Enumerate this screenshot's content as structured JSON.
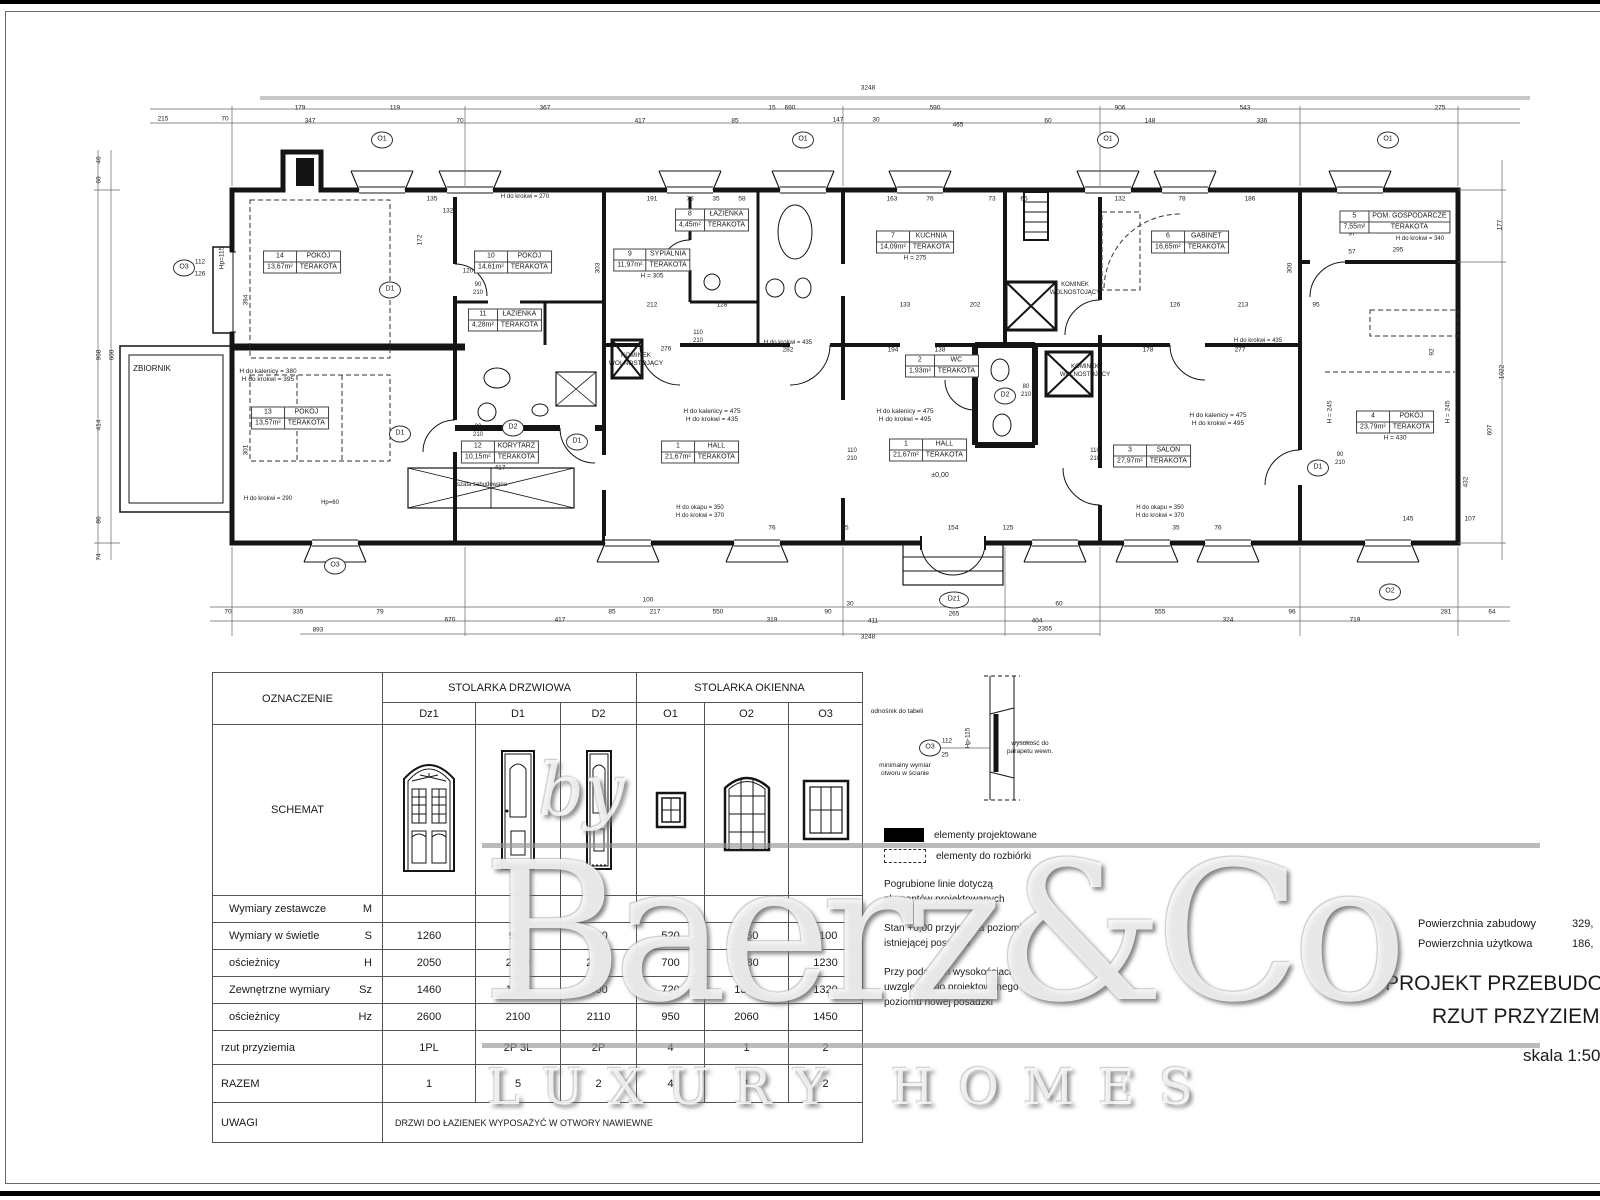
{
  "titleblock": {
    "area_label1": "Powierzchnia zabudowy",
    "area_value1": "329,",
    "area_label2": "Powierzchnia użytkowa",
    "area_value2": "186,",
    "title1": "PROJEKT PRZEBUDOWY",
    "title2": "RZUT PRZYZIEMIA",
    "scale": "skala 1:50"
  },
  "watermark": {
    "by": "by",
    "brand": "Baerz&Co",
    "tagline": "LUXURY HOMES"
  },
  "legend": {
    "items": [
      {
        "label": "elementy projektowane",
        "swatch": "black-fill"
      },
      {
        "label": "elementy do rozbiórki",
        "swatch": "dashed-outline"
      }
    ],
    "notes": [
      [
        "Pogrubione linie dotyczą",
        "elementów projektowanych"
      ],
      [
        "Stan +0,00 przyjęto na poziomie",
        "istniejącej posadzki"
      ],
      [
        "Przy podanych wysokościach",
        "uwzględniono projektowanego",
        "poziomu nowej posadzki"
      ]
    ]
  },
  "table": {
    "corner": "OZNACZENIE",
    "group1": "STOLARKA DRZWIOWA",
    "group2": "STOLARKA OKIENNA",
    "schemat_label": "SCHEMAT",
    "cols": [
      "Dz1",
      "D1",
      "D2",
      "O1",
      "O2",
      "O3"
    ],
    "rows": [
      {
        "label": "Wymiary zestawcze",
        "sub": "M",
        "cls": "r27",
        "values": [
          "",
          "",
          "",
          "",
          "",
          ""
        ]
      },
      {
        "label": "Wymiary w świetle",
        "sub": "S",
        "cls": "r27",
        "values": [
          "1260",
          "900",
          "700",
          "520",
          "1160",
          "1100"
        ]
      },
      {
        "label": "ościeżnicy",
        "sub": "H",
        "cls": "r27",
        "values": [
          "2050",
          "2050",
          "2020",
          "700",
          "1880",
          "1230"
        ]
      },
      {
        "label": "Zewnętrzne wymiary",
        "sub": "Sz",
        "cls": "r27",
        "values": [
          "1460",
          "1000",
          "800",
          "720",
          "1340",
          "1320"
        ]
      },
      {
        "label": "ościeżnicy",
        "sub": "Hz",
        "cls": "r27",
        "values": [
          "2600",
          "2100",
          "2110",
          "950",
          "2060",
          "1450"
        ]
      },
      {
        "label": "rzut przyziemia",
        "sub": "",
        "cls": "rzut",
        "values": [
          "1PL",
          "2P  3L",
          "2P",
          "4",
          "1",
          "2"
        ]
      },
      {
        "label": "RAZEM",
        "sub": "",
        "cls": "razem",
        "values": [
          "1",
          "5",
          "2",
          "4",
          "1",
          "2"
        ]
      },
      {
        "label": "UWAGI",
        "sub": "",
        "cls": "uwagi",
        "span": "DRZWI DO ŁAZIENEK WYPOSAŻYĆ W OTWORY NAWIEWNE"
      }
    ]
  },
  "plan": {
    "rooms": [
      {
        "num": "14",
        "name": "POKÓJ",
        "area": "13,67m²",
        "fin": "TERAKOTA",
        "x": 302,
        "y": 262
      },
      {
        "num": "13",
        "name": "POKÓJ",
        "area": "13,57m²",
        "fin": "TERAKOTA",
        "x": 290,
        "y": 418
      },
      {
        "num": "10",
        "name": "POKÓJ",
        "area": "14,61m²",
        "fin": "TERAKOTA",
        "x": 513,
        "y": 262
      },
      {
        "num": "11",
        "name": "ŁAZIENKA",
        "area": "4,28m²",
        "fin": "TERAKOTA",
        "x": 505,
        "y": 320
      },
      {
        "num": "12",
        "name": "KORYTARZ",
        "area": "10,15m²",
        "fin": "TERAKOTA",
        "x": 500,
        "y": 452,
        "extra": "417"
      },
      {
        "num": "9",
        "name": "SYPIALNIA",
        "area": "11,97m²",
        "fin": "TERAKOTA",
        "x": 652,
        "y": 260,
        "extra": "H = 305"
      },
      {
        "num": "8",
        "name": "ŁAZIENKA",
        "area": "4,45m²",
        "fin": "TERAKOTA",
        "x": 712,
        "y": 220
      },
      {
        "num": "7",
        "name": "KUCHNIA",
        "area": "14,09m²",
        "fin": "TERAKOTA",
        "x": 915,
        "y": 242,
        "extra": "H = 275"
      },
      {
        "num": "1",
        "name": "HALL",
        "area": "21,67m²",
        "fin": "TERAKOTA",
        "x": 700,
        "y": 452
      },
      {
        "num": "1",
        "name": "HALL",
        "area": "21,67m²",
        "fin": "TERAKOTA",
        "x": 928,
        "y": 450
      },
      {
        "num": "2",
        "name": "WC",
        "area": "1,93m²",
        "fin": "TERAKOTA",
        "x": 942,
        "y": 366
      },
      {
        "num": "6",
        "name": "GABINET",
        "area": "16,65m²",
        "fin": "TERAKOTA",
        "x": 1190,
        "y": 242
      },
      {
        "num": "3",
        "name": "SALON",
        "area": "27,97m²",
        "fin": "TERAKOTA",
        "x": 1152,
        "y": 456
      },
      {
        "num": "5",
        "name": "POM. GOSPODARCZE",
        "area": "7,55m²",
        "fin": "TERAKOTA",
        "x": 1395,
        "y": 222
      },
      {
        "num": "4",
        "name": "POKÓJ",
        "area": "23,79m²",
        "fin": "TERAKOTA",
        "x": 1395,
        "y": 422,
        "extra": "H = 430"
      }
    ],
    "annotations": [
      {
        "x": 152,
        "y": 364,
        "s": 8,
        "l": [
          "ZBIORNIK"
        ]
      },
      {
        "x": 268,
        "y": 368,
        "s": 6.5,
        "l": [
          "H do kalenicy = 380",
          "H do krokwi = 395"
        ]
      },
      {
        "x": 525,
        "y": 194,
        "s": 6,
        "l": [
          "H do krokwi = 270"
        ]
      },
      {
        "x": 636,
        "y": 352,
        "s": 6.5,
        "l": [
          "KOMINEK",
          "WOLNOSTOJĄCY"
        ]
      },
      {
        "x": 712,
        "y": 408,
        "s": 6.5,
        "l": [
          "H do kalenicy = 475",
          "H do krokwi = 435"
        ]
      },
      {
        "x": 788,
        "y": 340,
        "s": 6,
        "l": [
          "H do krokwi = 435"
        ]
      },
      {
        "x": 905,
        "y": 408,
        "s": 6.5,
        "l": [
          "H do kalenicy = 475",
          "H do krokwi = 495"
        ]
      },
      {
        "x": 1075,
        "y": 282,
        "s": 6,
        "l": [
          "KOMINEK",
          "WOLNOSTOJĄCY"
        ]
      },
      {
        "x": 1085,
        "y": 364,
        "s": 6,
        "l": [
          "KOMINEK",
          "WOLNOSTOJĄCY"
        ]
      },
      {
        "x": 1218,
        "y": 412,
        "s": 6.5,
        "l": [
          "H do kalenicy = 475",
          "H do krokwi = 495"
        ]
      },
      {
        "x": 1258,
        "y": 338,
        "s": 6,
        "l": [
          "H do krokwi = 435"
        ]
      },
      {
        "x": 700,
        "y": 505,
        "s": 6,
        "l": [
          "H do okapu = 350",
          "H do krokwi = 370"
        ]
      },
      {
        "x": 1160,
        "y": 505,
        "s": 6,
        "l": [
          "H do okapu = 350",
          "H do krokwi = 370"
        ]
      },
      {
        "x": 1415,
        "y": 188,
        "s": 6,
        "l": [
          "H do krokwi = 385"
        ]
      },
      {
        "x": 1420,
        "y": 236,
        "s": 6,
        "l": [
          "H do krokwi = 340"
        ]
      },
      {
        "x": 482,
        "y": 482,
        "s": 6,
        "l": [
          "szafa zabudowana"
        ]
      },
      {
        "x": 268,
        "y": 496,
        "s": 6,
        "l": [
          "H do krokwi = 290"
        ]
      },
      {
        "x": 330,
        "y": 500,
        "s": 6,
        "l": [
          "Hp=60"
        ]
      },
      {
        "x": 940,
        "y": 472,
        "s": 7,
        "l": [
          "±0,00"
        ]
      },
      {
        "x": 478,
        "y": 282,
        "s": 6,
        "l": [
          "90",
          "210"
        ]
      },
      {
        "x": 478,
        "y": 424,
        "s": 6,
        "l": [
          "90",
          "210"
        ]
      },
      {
        "x": 698,
        "y": 330,
        "s": 6,
        "l": [
          "110",
          "210"
        ]
      },
      {
        "x": 852,
        "y": 448,
        "s": 6,
        "l": [
          "110",
          "210"
        ]
      },
      {
        "x": 1095,
        "y": 448,
        "s": 6,
        "l": [
          "110",
          "210"
        ]
      },
      {
        "x": 1026,
        "y": 384,
        "s": 6,
        "l": [
          "80",
          "210"
        ]
      },
      {
        "x": 1340,
        "y": 452,
        "s": 6,
        "l": [
          "90",
          "210"
        ]
      },
      {
        "x": 897,
        "y": 708,
        "s": 6.5,
        "l": [
          "odnośnik do tabeli"
        ]
      },
      {
        "x": 905,
        "y": 762,
        "s": 6.5,
        "l": [
          "minimalny wymiar",
          "otworu w ścianie"
        ]
      },
      {
        "x": 1030,
        "y": 740,
        "s": 6.5,
        "l": [
          "wysokość do",
          "parapetu wewn."
        ]
      }
    ],
    "markers": [
      {
        "x": 382,
        "y": 140,
        "t": "O1"
      },
      {
        "x": 803,
        "y": 140,
        "t": "O1"
      },
      {
        "x": 1108,
        "y": 140,
        "t": "O1"
      },
      {
        "x": 1388,
        "y": 140,
        "t": "O1"
      },
      {
        "x": 184,
        "y": 268,
        "t": "O3"
      },
      {
        "x": 335,
        "y": 566,
        "t": "O3"
      },
      {
        "x": 954,
        "y": 600,
        "t": "Dz1",
        "w": 28
      },
      {
        "x": 1390,
        "y": 592,
        "t": "O2"
      },
      {
        "x": 390,
        "y": 290,
        "t": "D1"
      },
      {
        "x": 400,
        "y": 434,
        "t": "D1"
      },
      {
        "x": 577,
        "y": 442,
        "t": "D1"
      },
      {
        "x": 1318,
        "y": 468,
        "t": "D1"
      },
      {
        "x": 513,
        "y": 428,
        "t": "D2"
      },
      {
        "x": 1005,
        "y": 396,
        "t": "D2"
      },
      {
        "x": 930,
        "y": 748,
        "t": "O3"
      }
    ],
    "dims": [
      {
        "t": "3248",
        "x": 868,
        "y": 88
      },
      {
        "t": "215",
        "x": 163,
        "y": 119
      },
      {
        "t": "70",
        "x": 225,
        "y": 119
      },
      {
        "t": "179",
        "x": 300,
        "y": 108
      },
      {
        "t": "347",
        "x": 310,
        "y": 121
      },
      {
        "t": "119",
        "x": 395,
        "y": 108
      },
      {
        "t": "70",
        "x": 460,
        "y": 121
      },
      {
        "t": "367",
        "x": 545,
        "y": 108
      },
      {
        "t": "417",
        "x": 640,
        "y": 121
      },
      {
        "t": "690",
        "x": 790,
        "y": 108
      },
      {
        "t": "85",
        "x": 735,
        "y": 121
      },
      {
        "t": "15",
        "x": 772,
        "y": 108
      },
      {
        "t": "590",
        "x": 935,
        "y": 108
      },
      {
        "t": "147",
        "x": 838,
        "y": 120
      },
      {
        "t": "30",
        "x": 876,
        "y": 120
      },
      {
        "t": "465",
        "x": 958,
        "y": 125
      },
      {
        "t": "60",
        "x": 1048,
        "y": 121
      },
      {
        "t": "906",
        "x": 1120,
        "y": 108
      },
      {
        "t": "148",
        "x": 1150,
        "y": 121
      },
      {
        "t": "543",
        "x": 1245,
        "y": 108
      },
      {
        "t": "336",
        "x": 1262,
        "y": 121
      },
      {
        "t": "275",
        "x": 1440,
        "y": 108
      },
      {
        "t": "70",
        "x": 228,
        "y": 612
      },
      {
        "t": "335",
        "x": 298,
        "y": 612
      },
      {
        "t": "79",
        "x": 380,
        "y": 612
      },
      {
        "t": "670",
        "x": 450,
        "y": 620
      },
      {
        "t": "417",
        "x": 560,
        "y": 620
      },
      {
        "t": "85",
        "x": 612,
        "y": 612
      },
      {
        "t": "217",
        "x": 655,
        "y": 612
      },
      {
        "t": "550",
        "x": 718,
        "y": 612
      },
      {
        "t": "319",
        "x": 772,
        "y": 620
      },
      {
        "t": "90",
        "x": 828,
        "y": 612
      },
      {
        "t": "30",
        "x": 850,
        "y": 604
      },
      {
        "t": "411",
        "x": 873,
        "y": 621
      },
      {
        "t": "265",
        "x": 954,
        "y": 614
      },
      {
        "t": "404",
        "x": 1037,
        "y": 621
      },
      {
        "t": "60",
        "x": 1059,
        "y": 604
      },
      {
        "t": "555",
        "x": 1160,
        "y": 612
      },
      {
        "t": "324",
        "x": 1228,
        "y": 620
      },
      {
        "t": "96",
        "x": 1292,
        "y": 612
      },
      {
        "t": "719",
        "x": 1355,
        "y": 620
      },
      {
        "t": "281",
        "x": 1446,
        "y": 612
      },
      {
        "t": "64",
        "x": 1492,
        "y": 612
      },
      {
        "t": "893",
        "x": 318,
        "y": 630
      },
      {
        "t": "2355",
        "x": 1045,
        "y": 629
      },
      {
        "t": "3248",
        "x": 868,
        "y": 637
      },
      {
        "t": "100",
        "x": 648,
        "y": 600
      },
      {
        "t": "46",
        "x": 99,
        "y": 160,
        "v": 1
      },
      {
        "t": "60",
        "x": 99,
        "y": 180,
        "v": 1
      },
      {
        "t": "968",
        "x": 99,
        "y": 355,
        "v": 1
      },
      {
        "t": "600",
        "x": 112,
        "y": 355,
        "v": 1
      },
      {
        "t": "414",
        "x": 99,
        "y": 425,
        "v": 1
      },
      {
        "t": "86",
        "x": 99,
        "y": 520,
        "v": 1
      },
      {
        "t": "74",
        "x": 99,
        "y": 557,
        "v": 1
      },
      {
        "t": "394",
        "x": 246,
        "y": 300,
        "v": 1
      },
      {
        "t": "301",
        "x": 246,
        "y": 450,
        "v": 1
      },
      {
        "t": "Hp=115",
        "x": 222,
        "y": 258,
        "v": 1
      },
      {
        "t": "112",
        "x": 200,
        "y": 262
      },
      {
        "t": "126",
        "x": 200,
        "y": 274
      },
      {
        "t": "177",
        "x": 1500,
        "y": 225,
        "v": 1
      },
      {
        "t": "1022",
        "x": 1502,
        "y": 372,
        "v": 1
      },
      {
        "t": "607",
        "x": 1490,
        "y": 430,
        "v": 1
      },
      {
        "t": "432",
        "x": 1466,
        "y": 482,
        "v": 1
      },
      {
        "t": "92",
        "x": 1432,
        "y": 352,
        "v": 1
      },
      {
        "t": "295",
        "x": 1398,
        "y": 250
      },
      {
        "t": "97",
        "x": 1352,
        "y": 234
      },
      {
        "t": "57",
        "x": 1352,
        "y": 252
      },
      {
        "t": "H = 245",
        "x": 1330,
        "y": 412,
        "v": 1
      },
      {
        "t": "H = 245",
        "x": 1448,
        "y": 412,
        "v": 1
      },
      {
        "t": "135",
        "x": 432,
        "y": 199
      },
      {
        "t": "132",
        "x": 448,
        "y": 211
      },
      {
        "t": "120",
        "x": 468,
        "y": 271
      },
      {
        "t": "172",
        "x": 420,
        "y": 240,
        "v": 1
      },
      {
        "t": "191",
        "x": 652,
        "y": 199
      },
      {
        "t": "76",
        "x": 690,
        "y": 199
      },
      {
        "t": "35",
        "x": 716,
        "y": 199
      },
      {
        "t": "58",
        "x": 742,
        "y": 199
      },
      {
        "t": "212",
        "x": 652,
        "y": 305
      },
      {
        "t": "128",
        "x": 722,
        "y": 305
      },
      {
        "t": "276",
        "x": 666,
        "y": 349
      },
      {
        "t": "303",
        "x": 598,
        "y": 268,
        "v": 1
      },
      {
        "t": "282",
        "x": 788,
        "y": 350
      },
      {
        "t": "163",
        "x": 892,
        "y": 199
      },
      {
        "t": "76",
        "x": 930,
        "y": 199
      },
      {
        "t": "73",
        "x": 992,
        "y": 199
      },
      {
        "t": "65",
        "x": 1024,
        "y": 199
      },
      {
        "t": "133",
        "x": 905,
        "y": 305
      },
      {
        "t": "202",
        "x": 975,
        "y": 305
      },
      {
        "t": "194",
        "x": 893,
        "y": 350
      },
      {
        "t": "138",
        "x": 940,
        "y": 350
      },
      {
        "t": "132",
        "x": 1120,
        "y": 199
      },
      {
        "t": "78",
        "x": 1182,
        "y": 199
      },
      {
        "t": "186",
        "x": 1250,
        "y": 199
      },
      {
        "t": "300",
        "x": 1290,
        "y": 268,
        "v": 1
      },
      {
        "t": "213",
        "x": 1243,
        "y": 305
      },
      {
        "t": "95",
        "x": 1316,
        "y": 305
      },
      {
        "t": "126",
        "x": 1175,
        "y": 305
      },
      {
        "t": "277",
        "x": 1240,
        "y": 350
      },
      {
        "t": "178",
        "x": 1148,
        "y": 350
      },
      {
        "t": "154",
        "x": 953,
        "y": 528
      },
      {
        "t": "125",
        "x": 1008,
        "y": 528
      },
      {
        "t": "45",
        "x": 845,
        "y": 528
      },
      {
        "t": "76",
        "x": 772,
        "y": 528
      },
      {
        "t": "76",
        "x": 1218,
        "y": 528
      },
      {
        "t": "35",
        "x": 1176,
        "y": 528
      },
      {
        "t": "145",
        "x": 1408,
        "y": 519
      },
      {
        "t": "107",
        "x": 1470,
        "y": 519
      },
      {
        "t": "44",
        "x": 397,
        "y": 760,
        "v": 1
      },
      {
        "t": "12.5",
        "x": 468,
        "y": 762,
        "v": 1
      },
      {
        "t": "205",
        "x": 390,
        "y": 818,
        "v": 1
      },
      {
        "t": "252.5",
        "x": 474,
        "y": 820,
        "v": 1
      },
      {
        "t": "10  126  10",
        "x": 431,
        "y": 884
      },
      {
        "t": "191",
        "x": 713,
        "y": 800,
        "v": 1
      },
      {
        "t": "176.5",
        "x": 776,
        "y": 813,
        "v": 1
      },
      {
        "t": "112",
        "x": 947,
        "y": 741
      },
      {
        "t": "25",
        "x": 945,
        "y": 755
      },
      {
        "t": "Hp-115",
        "x": 968,
        "y": 738,
        "v": 1
      }
    ]
  }
}
